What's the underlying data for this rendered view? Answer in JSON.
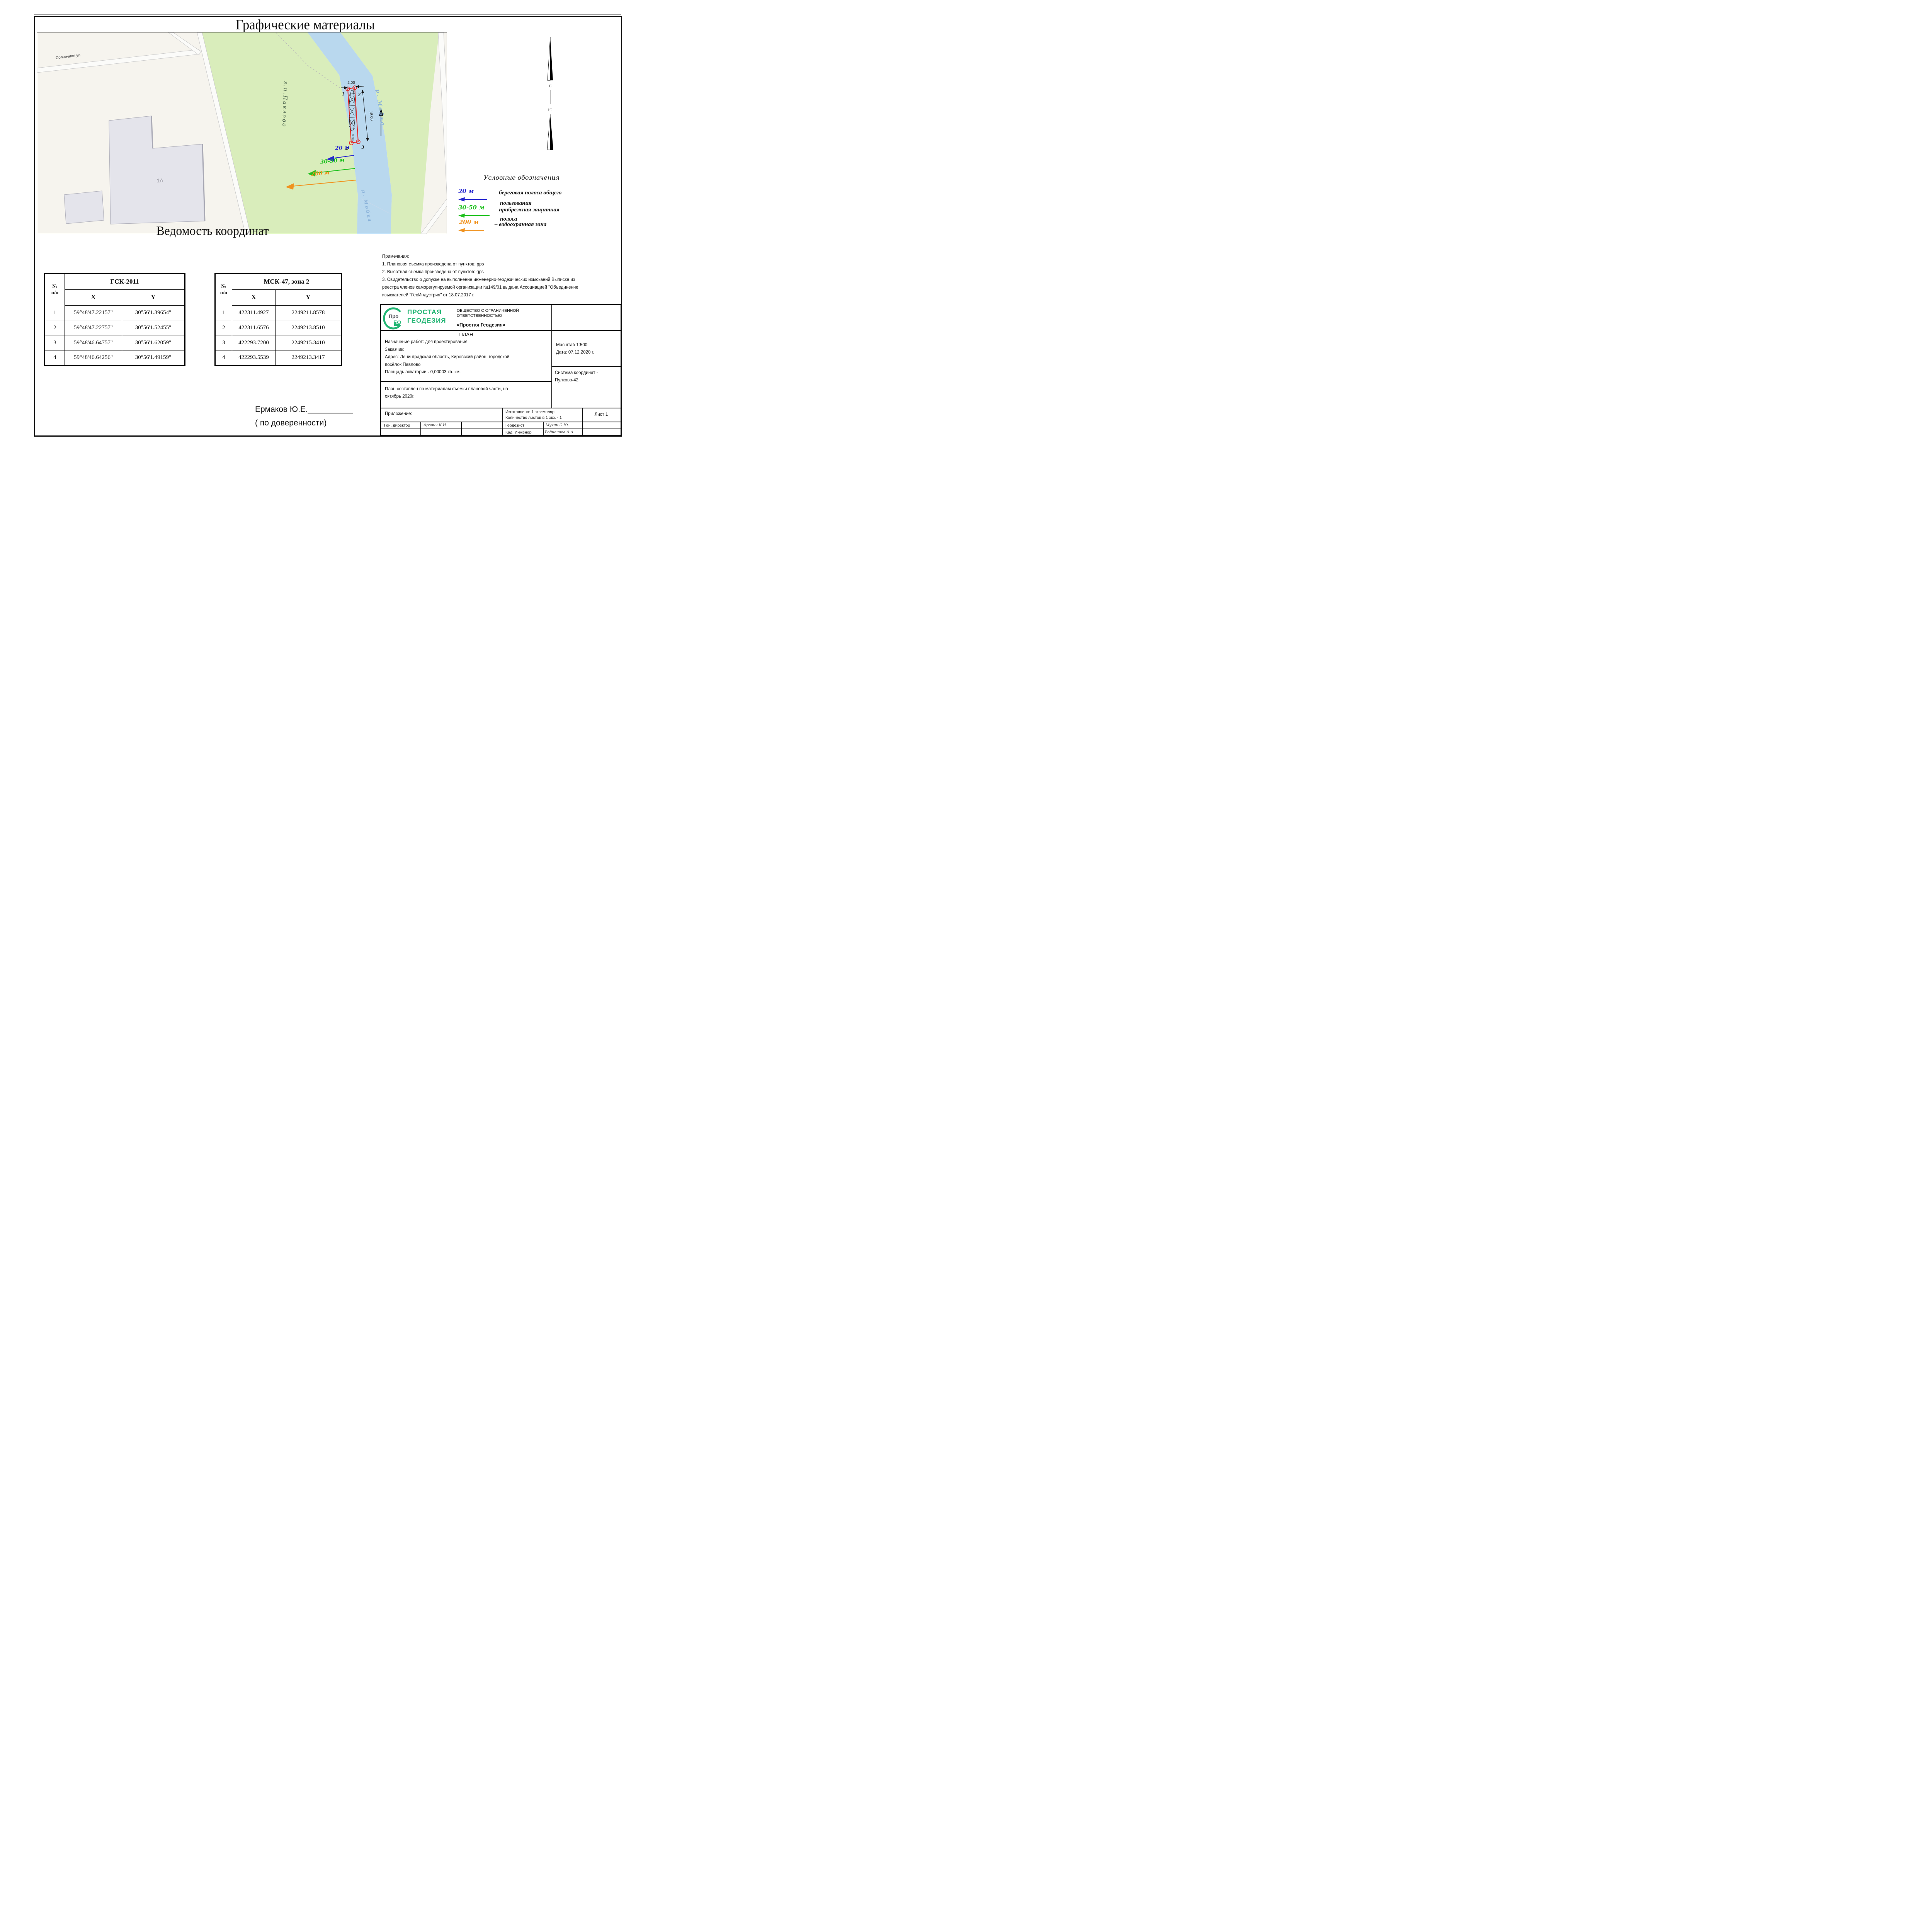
{
  "page": {
    "title": "Графические материалы",
    "coords_heading": "Ведомость координат"
  },
  "map": {
    "street": "Солнечная ул.",
    "settlement": "г.п.Павлово",
    "river_label_upper": "р. Мойка",
    "river_label_lower": "р. Мойка",
    "building": "1А",
    "pontoon": "понтон",
    "dim_top": "2.00",
    "dim_side": "18.00",
    "p1": "1",
    "p2": "2",
    "p3": "3",
    "p4": "4",
    "zone20": "20 м",
    "zone3050": "30-50 м",
    "zone200": "200 м"
  },
  "compass": {
    "north": "С",
    "south": "Ю"
  },
  "legend": {
    "title": "Условные обозначения",
    "item1": {
      "label": "20 м",
      "desc1": "– береговая полоса общего",
      "desc2": "пользования"
    },
    "item2": {
      "label": "30-50 м",
      "desc1": "– прибрежная защитная",
      "desc2": "полоса"
    },
    "item3": {
      "label": "200 м",
      "desc1": "– водоохранная зона"
    }
  },
  "tables": {
    "gsk": {
      "no1": "№",
      "no2": "п/п",
      "title": "ГСК-2011",
      "x": "X",
      "y": "Y",
      "rows": [
        {
          "n": "1",
          "x": "59°48'47.22157\"",
          "y": "30°56'1.39654\""
        },
        {
          "n": "2",
          "x": "59°48'47.22757\"",
          "y": "30°56'1.52455\""
        },
        {
          "n": "3",
          "x": "59°48'46.64757\"",
          "y": "30°56'1.62059\""
        },
        {
          "n": "4",
          "x": "59°48'46.64256\"",
          "y": "30°56'1.49159\""
        }
      ]
    },
    "msk": {
      "no1": "№",
      "no2": "п/п",
      "title": "МСК-47, зона 2",
      "x": "X",
      "y": "Y",
      "rows": [
        {
          "n": "1",
          "x": "422311.4927",
          "y": "2249211.8578"
        },
        {
          "n": "2",
          "x": "422311.6576",
          "y": "2249213.8510"
        },
        {
          "n": "3",
          "x": "422293.7200",
          "y": "2249215.3410"
        },
        {
          "n": "4",
          "x": "422293.5539",
          "y": "2249213.3417"
        }
      ]
    }
  },
  "notes": {
    "title": "Примечания:",
    "line1": " 1. Плановая съемка произведена от пунктов: gps",
    "line2": "2. Высотная съемка произведена от пунктов: gps",
    "line3": "3. Свидетельство о допуске на выполнение инженерно-геодезических изысканий Выписка из",
    "line4": "реестра членов саморегулируемой организации №149/01 выдана Ассоциацией \"Объединение",
    "line5": "изыскателей \"ГеоИндустрия\" от 18.07.2017 г."
  },
  "stamp": {
    "logo_pro": "Про",
    "logo_geo": "ЕО",
    "logo_line1": "ПРОСТАЯ",
    "logo_line2": "ГЕОДЕЗИЯ",
    "ooo_line1": "ОБЩЕСТВО С ОГРАНИЧЕННОЙ",
    "ooo_line2": "ОТВЕТСТВЕННОСТЬЮ",
    "company": "«Простая Геодезия»",
    "plan": "ПЛАН",
    "purpose": "Назначение работ: для проектирования",
    "customer": "Заказчик:",
    "address1": "Адрес: Ленинградская область, Кировский район,  городской",
    "address2": "посёлок Павлово",
    "area": "Площадь акватории - 0,00003 кв. км.",
    "scale": "Масштаб 1:500",
    "date": "Дата: 07.12.2020 г.",
    "cs1": "Система координат -",
    "cs2": "Пулково-42",
    "made1": "План составлен по материалам съемки плановой части, на",
    "made2": "октябрь 2020г.",
    "attachment": "Приложение:",
    "made_count1": "Изготовлено: 1 экземпляр",
    "made_count2": "Количество листов в 1 экз. - 1",
    "sheet": "Лист 1",
    "role1": "Ген. директор",
    "sign1": "Арович К.И.",
    "role2": "Геодезист",
    "sign2": "Мухин С.Ю.",
    "role3": "Кад. Инженер",
    "sign3": "Родионова А.А."
  },
  "signature": {
    "name": "Ермаков Ю.Е.__________",
    "note": "( по доверенности)"
  },
  "colors": {
    "logo_green": "#21b573",
    "map_green": "#d9edbb",
    "river_blue": "#b9d8ee",
    "zone_blue": "#2626cf",
    "zone_green": "#1fc11f",
    "zone_orange": "#f0921e",
    "plot_red": "#e62521"
  }
}
